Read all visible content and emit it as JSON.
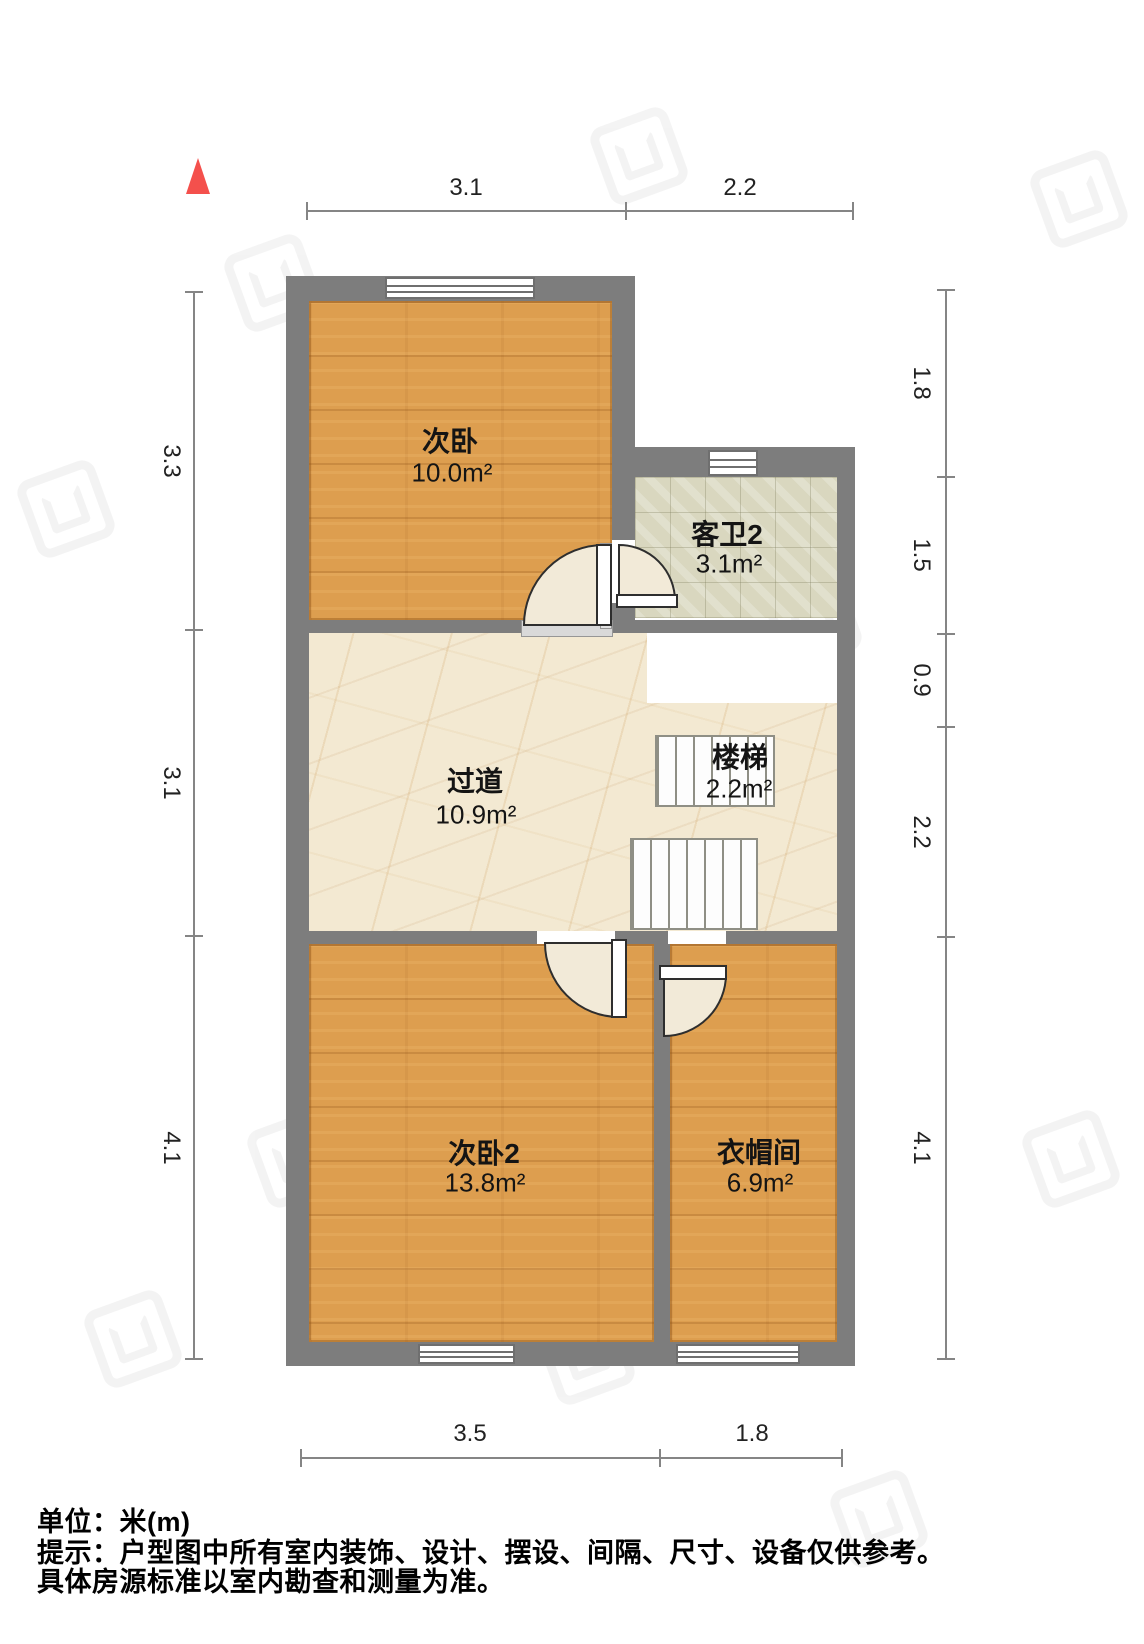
{
  "rooms": [
    {
      "id": "bedroom1",
      "name": "次卧",
      "area": "10.0m²",
      "floor": "wood"
    },
    {
      "id": "bathroom2",
      "name": "客卫2",
      "area": "3.1m²",
      "floor": "tile"
    },
    {
      "id": "hallway",
      "name": "过道",
      "area": "10.9m²",
      "floor": "marble"
    },
    {
      "id": "stairs",
      "name": "楼梯",
      "area": "2.2m²",
      "floor": "marble"
    },
    {
      "id": "bedroom2",
      "name": "次卧2",
      "area": "13.8m²",
      "floor": "wood"
    },
    {
      "id": "cloakroom",
      "name": "衣帽间",
      "area": "6.9m²",
      "floor": "wood"
    }
  ],
  "dimensions": {
    "top": [
      "3.1",
      "2.2"
    ],
    "bottom": [
      "3.5",
      "1.8"
    ],
    "left": [
      "3.3",
      "3.1",
      "4.1"
    ],
    "right": [
      "1.8",
      "1.5",
      "0.9",
      "2.2",
      "4.1"
    ]
  },
  "notes": {
    "unit": "单位：米(m)",
    "tip1": "提示：户型图中所有室内装饰、设计、摆设、间隔、尺寸、设备仅供参考。",
    "tip2": "具体房源标准以室内勘查和测量为准。"
  },
  "colors": {
    "wall": "#7d7d7d",
    "wood": "#dd9e4f",
    "tile": "#d9d7bf",
    "marble": "#f3e9d2",
    "door_swing": "#f2ead8",
    "north": "#f4504c",
    "dim": "#858585",
    "text": "#1c1c1c"
  }
}
